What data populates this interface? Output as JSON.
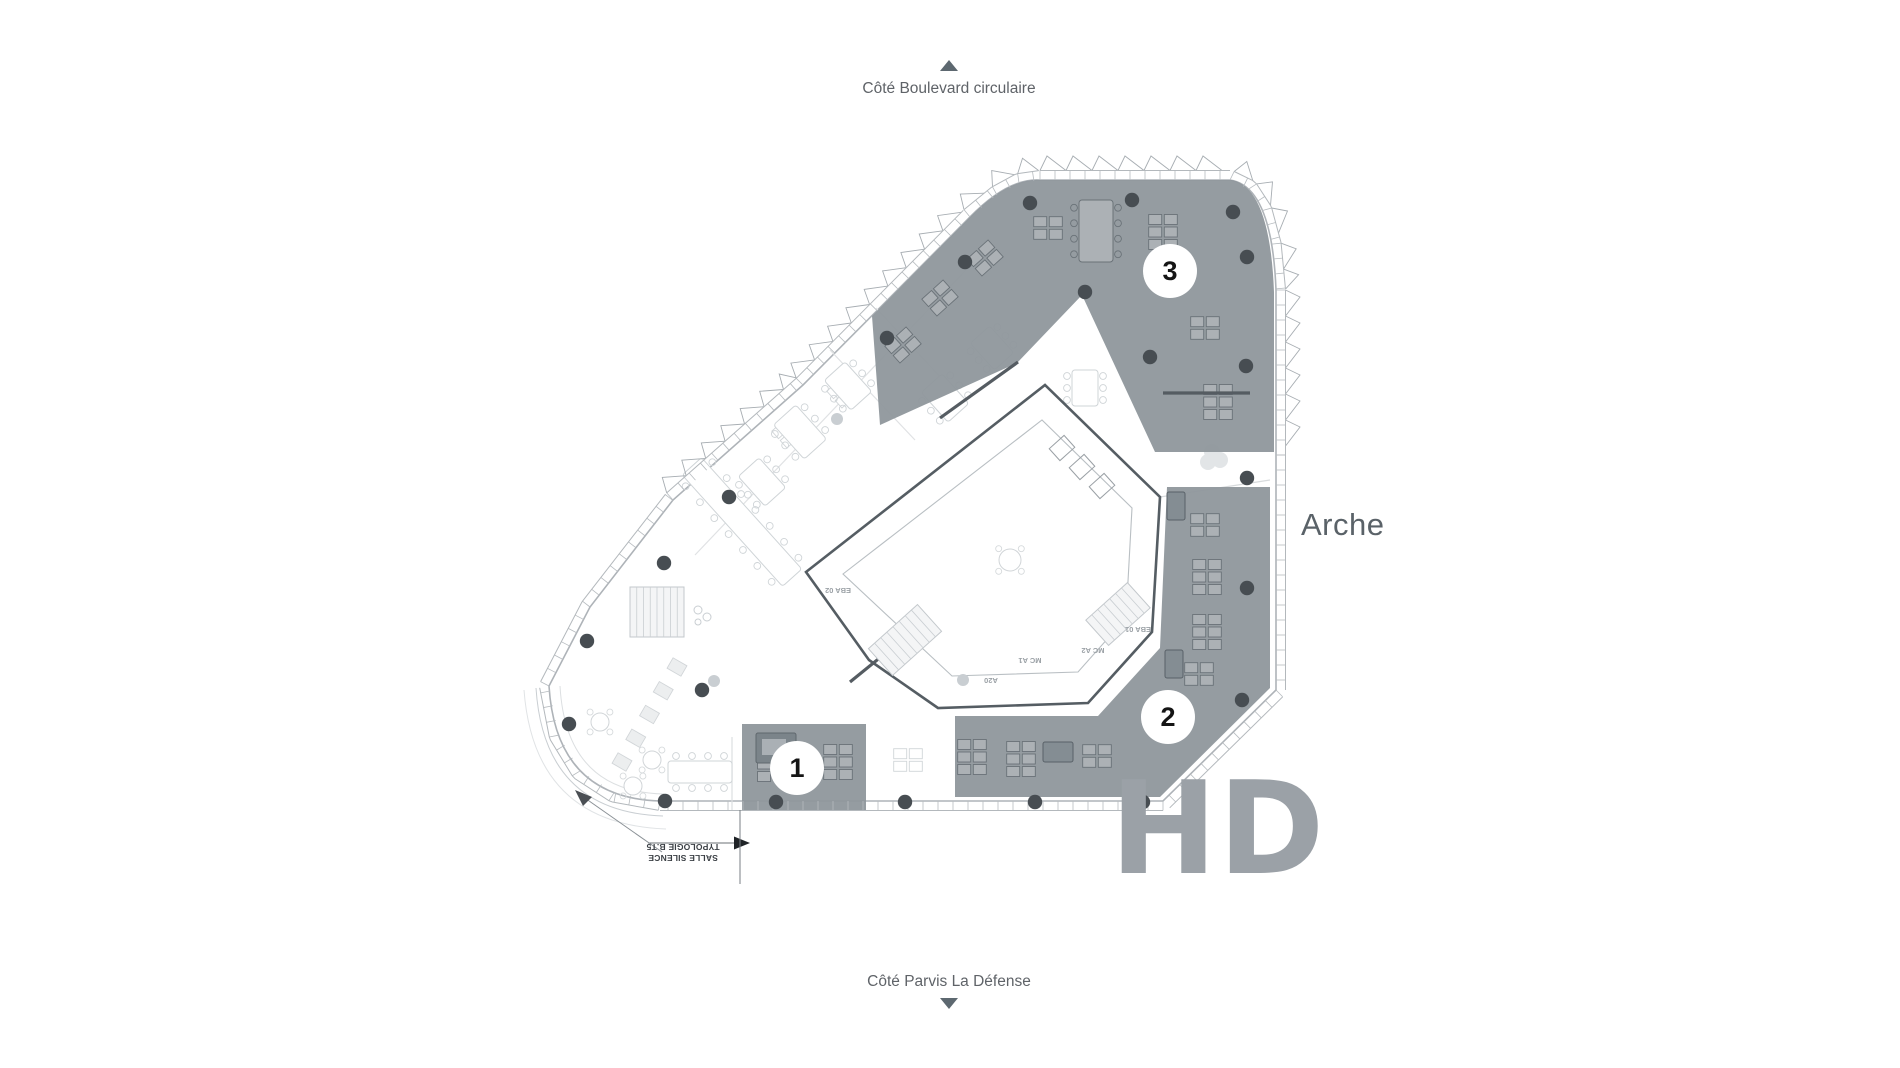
{
  "labels": {
    "top": {
      "text": "Côté Boulevard circulaire",
      "arrow": "up-arrow"
    },
    "bottom": {
      "text": "Côté Parvis La Défense",
      "arrow": "down-arrow"
    },
    "building_side": {
      "text": "Arche"
    },
    "watermark": {
      "text": "HD"
    }
  },
  "annotation": {
    "line1": "SALLE SILENCE",
    "line2": "TYPOLOGIE B.T5",
    "rotated_180": true
  },
  "zone_markers": [
    {
      "number": "1"
    },
    {
      "number": "2"
    },
    {
      "number": "3"
    }
  ],
  "room_labels": [
    {
      "text": "EBA 02"
    },
    {
      "text": "EBA 01"
    },
    {
      "text": "MC A1"
    },
    {
      "text": "MC A2"
    },
    {
      "text": "A20"
    }
  ],
  "colors": {
    "background": "#ffffff",
    "zone_fill": "#8f979c",
    "column_dot": "#474d52",
    "label_text": "#5f6368",
    "watermark_text": "#9ba1a7",
    "marker_bg": "#ffffff",
    "marker_text": "#151515",
    "plan_line": "#b0b5ba",
    "core_wall": "#555d63",
    "light_line": "#d6dadc"
  }
}
